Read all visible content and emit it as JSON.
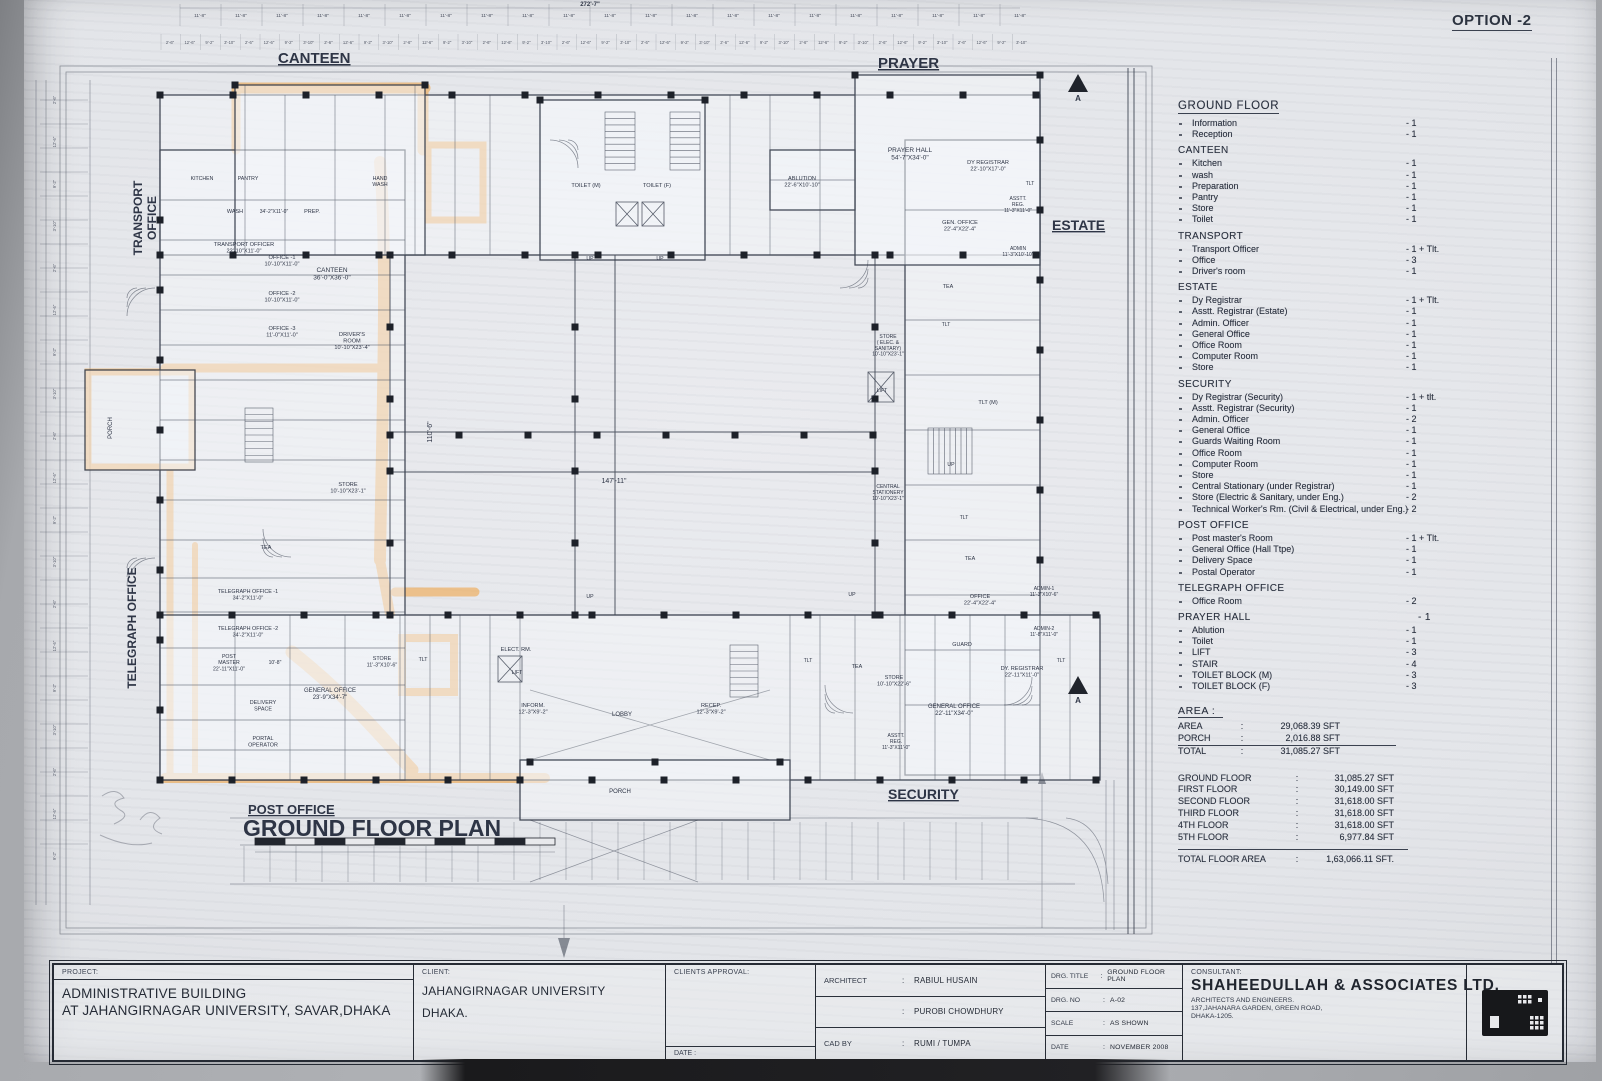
{
  "option_label": "OPTION -2",
  "colors": {
    "highlight": "#f1a03c",
    "ink": "#39404e",
    "paper": "#e3e5e9"
  },
  "plan": {
    "zones": [
      {
        "t": "CANTEEN",
        "x": 248,
        "y": 63,
        "s": 15,
        "u": 1
      },
      {
        "t": "PRAYER",
        "x": 848,
        "y": 68,
        "s": 15,
        "u": 1
      },
      {
        "t": "ESTATE",
        "x": 1022,
        "y": 230,
        "s": 14,
        "u": 1
      },
      {
        "t": "SECURITY",
        "x": 858,
        "y": 799,
        "s": 14,
        "u": 1
      },
      {
        "t": "TRANSPORT\nOFFICE",
        "x": 112,
        "y": 218,
        "s": 12,
        "r": -90,
        "a": "m"
      },
      {
        "t": "TELEGRAPH OFFICE",
        "x": 106,
        "y": 628,
        "s": 12,
        "r": -90,
        "a": "m"
      },
      {
        "t": "POST OFFICE",
        "x": 218,
        "y": 814,
        "s": 13,
        "u": 1
      },
      {
        "t": "GROUND FLOOR PLAN",
        "x": 213,
        "y": 836,
        "s": 23,
        "b": 1
      }
    ],
    "rooms": [
      {
        "t": "KITCHEN",
        "x": 172,
        "y": 180,
        "s": 5.2
      },
      {
        "t": "PANTRY",
        "x": 218,
        "y": 180,
        "s": 5.2
      },
      {
        "t": "HAND\nWASH",
        "x": 350,
        "y": 180,
        "s": 5.2
      },
      {
        "t": "CANTEEN\n36'-0\"X36'-0\"",
        "x": 302,
        "y": 272
      },
      {
        "t": "WASH",
        "x": 205,
        "y": 213,
        "s": 5.5
      },
      {
        "t": "34'-2\"X11'-0\"",
        "x": 244,
        "y": 213,
        "s": 5
      },
      {
        "t": "PREP.",
        "x": 282,
        "y": 213,
        "s": 5.5
      },
      {
        "t": "TRANSPORT OFFICER\n22'-10\"X11'-0\"",
        "x": 214,
        "y": 246,
        "s": 5.6
      },
      {
        "t": "OFFICE -1\n10'-10\"X11'-0\"",
        "x": 252,
        "y": 259,
        "s": 5.6
      },
      {
        "t": "OFFICE -2\n10'-10\"X11'-0\"",
        "x": 252,
        "y": 295,
        "s": 5.6
      },
      {
        "t": "OFFICE -3\n11'-0\"X11'-0\"",
        "x": 252,
        "y": 330,
        "s": 5.6
      },
      {
        "t": "DRIVER'S\nROOM\n10'-10\"X23'-4\"",
        "x": 322,
        "y": 336,
        "s": 5.6
      },
      {
        "t": "PORCH",
        "x": 82,
        "y": 428,
        "s": 6,
        "r": -90
      },
      {
        "t": "STORE\n10'-10\"X23'-1\"",
        "x": 318,
        "y": 486,
        "s": 5.6
      },
      {
        "t": "TEA",
        "x": 236,
        "y": 549,
        "s": 5.6
      },
      {
        "t": "TELEGRAPH OFFICE -1\n34'-2\"X11'-0\"",
        "x": 218,
        "y": 593,
        "s": 5.4
      },
      {
        "t": "TELEGRAPH OFFICE -2\n34'-2\"X11'-0\"",
        "x": 218,
        "y": 630,
        "s": 5.4
      },
      {
        "t": "POST\nMASTER\n22'-11\"X11'-0\"",
        "x": 199,
        "y": 658,
        "s": 5.2
      },
      {
        "t": "10'-8\"",
        "x": 245,
        "y": 664,
        "s": 5
      },
      {
        "t": "GENERAL OFFICE\n23'-9\"X34'-7\"",
        "x": 300,
        "y": 692,
        "s": 6
      },
      {
        "t": "DELIVERY\nSPACE",
        "x": 233,
        "y": 704,
        "s": 5.4
      },
      {
        "t": "PORTAL\nOPERATOR",
        "x": 233,
        "y": 740,
        "s": 5.4
      },
      {
        "t": "STORE\n11'-3\"X10'-6\"",
        "x": 352,
        "y": 660,
        "s": 5.4
      },
      {
        "t": "TLT",
        "x": 393,
        "y": 661,
        "s": 5.2
      },
      {
        "t": "ELECT. RM.",
        "x": 486,
        "y": 651,
        "s": 5.6
      },
      {
        "t": "LIFT",
        "x": 487,
        "y": 674,
        "s": 5.2
      },
      {
        "t": "INFORM.\n12'-3\"X9'-2\"",
        "x": 503,
        "y": 707,
        "s": 5.6
      },
      {
        "t": "LOBBY",
        "x": 592,
        "y": 716,
        "s": 6
      },
      {
        "t": "RECEP.\n12'-3\"X9'-2\"",
        "x": 681,
        "y": 707,
        "s": 5.6
      },
      {
        "t": "PORCH",
        "x": 590,
        "y": 793,
        "s": 6
      },
      {
        "t": "TOILET (M)",
        "x": 556,
        "y": 187,
        "s": 5.6
      },
      {
        "t": "TOILET (F)",
        "x": 627,
        "y": 187,
        "s": 5.6
      },
      {
        "t": "UP",
        "x": 560,
        "y": 260,
        "s": 5.2
      },
      {
        "t": "UP",
        "x": 630,
        "y": 260,
        "s": 5.2
      },
      {
        "t": "UP",
        "x": 560,
        "y": 598,
        "s": 5.2
      },
      {
        "t": "UP",
        "x": 822,
        "y": 596,
        "s": 5.2
      },
      {
        "t": "UP",
        "x": 921,
        "y": 466,
        "s": 5.2
      },
      {
        "t": "PRAYER HALL\n54'-7\"X34'-0\"",
        "x": 880,
        "y": 152
      },
      {
        "t": "ABLUTION\n22'-6\"X10'-10\"",
        "x": 772,
        "y": 180,
        "s": 5.6
      },
      {
        "t": "DY REGISTRAR\n22'-10\"X17'-0\"",
        "x": 958,
        "y": 164,
        "s": 5.6
      },
      {
        "t": "TLT",
        "x": 1000,
        "y": 185,
        "s": 5
      },
      {
        "t": "GEN. OFFICE\n22'-4\"X22'-4\"",
        "x": 930,
        "y": 224,
        "s": 5.6
      },
      {
        "t": "ASSTT.\nREG.\n11'-3\"X11'-0\"",
        "x": 988,
        "y": 200,
        "s": 5
      },
      {
        "t": "ADMIN\n11'-3\"X10'-10\"",
        "x": 988,
        "y": 250,
        "s": 5
      },
      {
        "t": "TEA",
        "x": 918,
        "y": 288,
        "s": 5.4
      },
      {
        "t": "TLT",
        "x": 916,
        "y": 326,
        "s": 5
      },
      {
        "t": "STORE\n( ELEC. &\nSANITARY)\n10'-10\"X23'-1\"",
        "x": 858,
        "y": 338,
        "s": 5
      },
      {
        "t": "LIFT",
        "x": 852,
        "y": 392,
        "s": 5.2
      },
      {
        "t": "CENTRAL\nSTATIONERY\n10'-10\"X23'-1\"",
        "x": 858,
        "y": 488,
        "s": 5
      },
      {
        "t": "TLT (M)",
        "x": 958,
        "y": 404,
        "s": 5.6
      },
      {
        "t": "TLT",
        "x": 934,
        "y": 519,
        "s": 5
      },
      {
        "t": "TEA",
        "x": 940,
        "y": 560,
        "s": 5.4
      },
      {
        "t": "OFFICE\n22'-4\"X22'-4\"",
        "x": 950,
        "y": 598,
        "s": 5.6
      },
      {
        "t": "ADMIN-1\n11'-3\"X10'-6\"",
        "x": 1014,
        "y": 590,
        "s": 5
      },
      {
        "t": "ADMIN-2\n11'-8\"X11'-0\"",
        "x": 1014,
        "y": 630,
        "s": 5
      },
      {
        "t": "GUARD",
        "x": 932,
        "y": 646,
        "s": 5.4
      },
      {
        "t": "DY. REGISTRAR\n22'-11\"X11'-0\"",
        "x": 992,
        "y": 670,
        "s": 5.6
      },
      {
        "t": "TLT",
        "x": 1031,
        "y": 662,
        "s": 5
      },
      {
        "t": "TLT",
        "x": 778,
        "y": 662,
        "s": 5
      },
      {
        "t": "TEA",
        "x": 827,
        "y": 668,
        "s": 5.4
      },
      {
        "t": "STORE\n10'-10\"X22'-6\"",
        "x": 864,
        "y": 679,
        "s": 5.4
      },
      {
        "t": "GENERAL OFFICE\n22'-11\"X34'-0\"",
        "x": 924,
        "y": 708,
        "s": 6
      },
      {
        "t": "ASSTT.\nREG.\n11'-3\"X11'-0\"",
        "x": 866,
        "y": 737,
        "s": 5
      },
      {
        "t": "147'-11\"",
        "x": 584,
        "y": 483,
        "s": 7
      },
      {
        "t": "110'-6\"",
        "x": 402,
        "y": 432,
        "s": 7,
        "r": -90
      },
      {
        "t": "A",
        "x": 1048,
        "y": 703,
        "s": 8,
        "b": 1
      },
      {
        "t": "A",
        "x": 1048,
        "y": 101,
        "s": 8,
        "b": 1
      }
    ],
    "dims": {
      "main": "11'-8\"",
      "total": "272'-7\"",
      "sub": [
        "2'-6\"",
        "12'-6\"",
        "9'-2\"",
        "3'-10\""
      ]
    }
  },
  "legend": {
    "title": "GROUND FLOOR",
    "sections": [
      {
        "title": "",
        "items": [
          {
            "label": "Information",
            "count": "1"
          },
          {
            "label": "Reception",
            "count": "1"
          }
        ]
      },
      {
        "title": "CANTEEN",
        "items": [
          {
            "label": "Kitchen",
            "count": "1"
          },
          {
            "label": "wash",
            "count": "1"
          },
          {
            "label": "Preparation",
            "count": "1"
          },
          {
            "label": "Pantry",
            "count": "1"
          },
          {
            "label": "Store",
            "count": "1"
          },
          {
            "label": "Toilet",
            "count": "1"
          }
        ]
      },
      {
        "title": "TRANSPORT",
        "items": [
          {
            "label": "Transport Officer",
            "count": "1 + Tlt."
          },
          {
            "label": "Office",
            "count": "3"
          },
          {
            "label": "Driver's room",
            "count": "1"
          }
        ]
      },
      {
        "title": "ESTATE",
        "items": [
          {
            "label": "Dy Registrar",
            "count": "1 + Tlt."
          },
          {
            "label": "Asstt. Registrar (Estate)",
            "count": "1"
          },
          {
            "label": "Admin. Officer",
            "count": "1"
          },
          {
            "label": "General Office",
            "count": "1"
          },
          {
            "label": "Office Room",
            "count": "1"
          },
          {
            "label": "Computer Room",
            "count": "1"
          },
          {
            "label": "Store",
            "count": "1"
          }
        ]
      },
      {
        "title": "SECURITY",
        "items": [
          {
            "label": "Dy Registrar (Security)",
            "count": "1 + tlt."
          },
          {
            "label": "Asstt. Registrar (Security)",
            "count": "1"
          },
          {
            "label": "Admin. Officer",
            "count": "2"
          },
          {
            "label": "General Office",
            "count": "1"
          },
          {
            "label": "Guards Waiting Room",
            "count": "1"
          },
          {
            "label": "Office Room",
            "count": "1"
          },
          {
            "label": "Computer Room",
            "count": "1"
          },
          {
            "label": "Store",
            "count": "1"
          },
          {
            "label": "Central Stationary (under Registrar)",
            "count": "1"
          },
          {
            "label": "Store (Electric & Sanitary, under Eng.)",
            "count": "2"
          },
          {
            "label": "Technical Worker's Rm. (Civil & Electrical, under Eng.)",
            "count": "2"
          }
        ]
      },
      {
        "title": "POST OFFICE",
        "items": [
          {
            "label": "Post master's Room",
            "count": "1 + Tlt."
          },
          {
            "label": "General Office (Hall Ttpe)",
            "count": "1"
          },
          {
            "label": "Delivery Space",
            "count": "1"
          },
          {
            "label": "Postal Operator",
            "count": "1"
          }
        ]
      },
      {
        "title": "TELEGRAPH OFFICE",
        "items": [
          {
            "label": "Office Room",
            "count": "2"
          }
        ]
      },
      {
        "title": "PRAYER HALL",
        "title_count": "1",
        "items": [
          {
            "label": "Ablution",
            "count": "1"
          },
          {
            "label": "Toilet",
            "count": "1"
          }
        ]
      },
      {
        "title": "",
        "items": [
          {
            "label": "LIFT",
            "count": "3"
          },
          {
            "label": "STAIR",
            "count": "4"
          },
          {
            "label": "TOILET BLOCK (M)",
            "count": "3"
          },
          {
            "label": "TOILET BLOCK (F)",
            "count": "3"
          }
        ]
      }
    ]
  },
  "area_block": {
    "title": "AREA :",
    "rows": [
      {
        "label": "AREA",
        "value": "29,068.39 SFT"
      },
      {
        "label": "PORCH",
        "value": "2,016.88 SFT"
      },
      {
        "label": "TOTAL",
        "value": "31,085.27 SFT"
      }
    ]
  },
  "floors_block": {
    "rows": [
      {
        "label": "GROUND FLOOR",
        "value": "31,085.27 SFT"
      },
      {
        "label": "FIRST FLOOR",
        "value": "30,149.00 SFT"
      },
      {
        "label": "SECOND FLOOR",
        "value": "31,618.00 SFT"
      },
      {
        "label": "THIRD FLOOR",
        "value": "31,618.00 SFT"
      },
      {
        "label": "4TH FLOOR",
        "value": "31,618.00 SFT"
      },
      {
        "label": "5TH FLOOR",
        "value": "6,977.84 SFT"
      }
    ],
    "total_label": "TOTAL FLOOR AREA",
    "total_value": "1,63,066.11 SFT."
  },
  "titleblock": {
    "project_label": "PROJECT:",
    "project_line1": "ADMINISTRATIVE BUILDING",
    "project_line2": "AT JAHANGIRNAGAR UNIVERSITY, SAVAR,DHAKA",
    "client_label": "CLIENT:",
    "client_line1": "JAHANGIRNAGAR UNIVERSITY",
    "client_line2": "DHAKA.",
    "approval_label": "CLIENTS APPROVAL:",
    "approval_date_label": "DATE :",
    "architect_label": "ARCHITECT",
    "architect_name1": "RABIUL HUSAIN",
    "architect_name2": "PUROBI CHOWDHURY",
    "cad_by_label": "CAD BY",
    "cad_by": "RUMI / TUMPA",
    "drg_title_label": "DRG. TITLE",
    "drg_title": "GROUND FLOOR PLAN",
    "drg_no_label": "DRG. NO",
    "drg_no": "A-02",
    "scale_label": "SCALE",
    "scale": "AS SHOWN",
    "date_label": "DATE",
    "date": "NOVEMBER 2008",
    "consultant_label": "CONSULTANT:",
    "consultant_name": "SHAHEEDULLAH & ASSOCIATES LTD.",
    "consultant_sub": "ARCHITECTS AND ENGINEERS.",
    "consultant_addr1": "137,JAHANARA GARDEN, GREEN ROAD,",
    "consultant_addr2": "DHAKA-1205."
  }
}
